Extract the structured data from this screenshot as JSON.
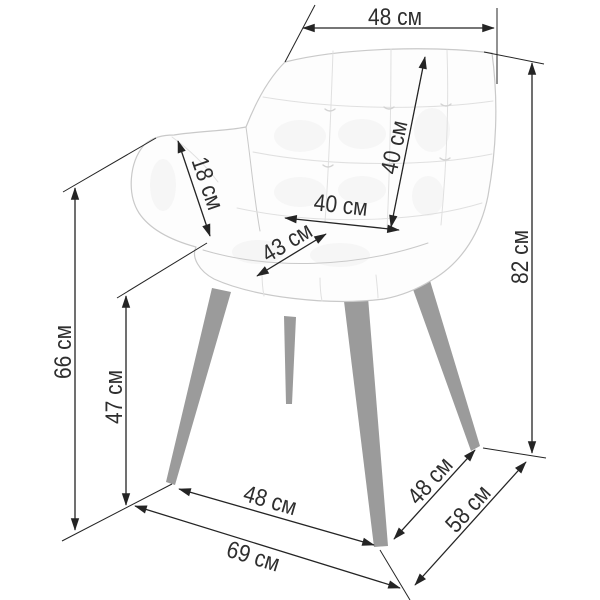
{
  "diagram": {
    "subject": "tufted-armchair-dimension-diagram",
    "unit": "см",
    "dims": {
      "top_width": "48 см",
      "backrest_height": "40 см",
      "seat_width": "40 см",
      "seat_diagonal": "43 см",
      "armrest_height": "18 см",
      "armrest_floor_height": "66 см",
      "seat_floor_height": "47 см",
      "total_height": "82 см",
      "front_width": "48 см",
      "overall_width": "69 см",
      "side_depth": "48 см",
      "overall_depth": "58 см"
    },
    "colors": {
      "dimension_line": "#242424",
      "label_text": "#2e2e2e",
      "leg_gray": "#9b9b9b",
      "sketch_line": "#c9c9c9",
      "sketch_light": "#e0e0e0",
      "background": "#ffffff"
    }
  }
}
